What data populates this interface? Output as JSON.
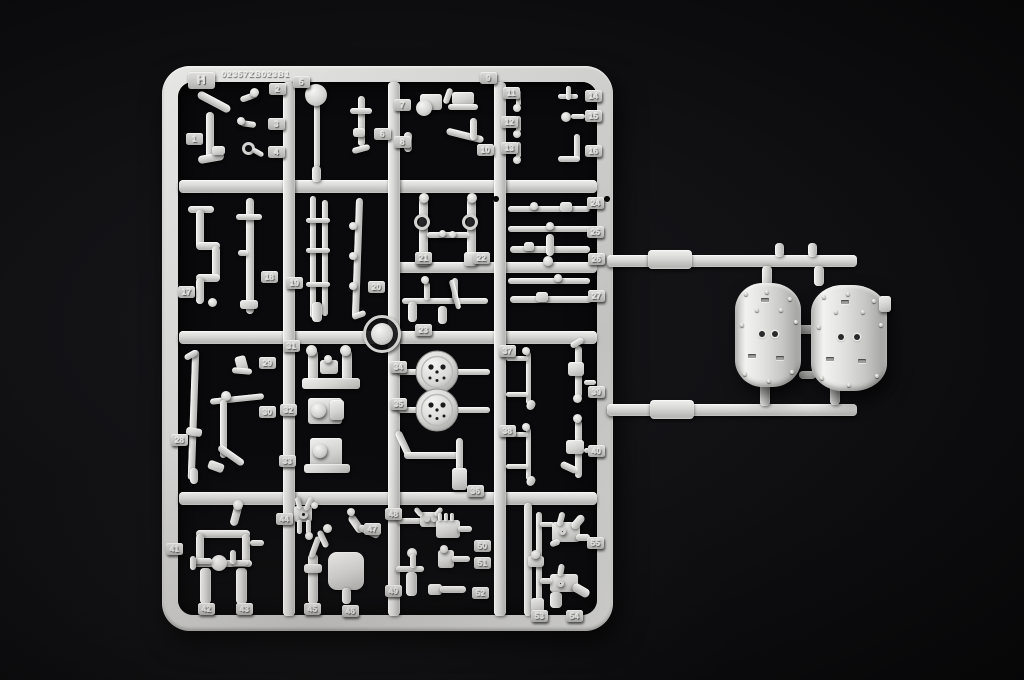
{
  "scene": {
    "type": "photograph",
    "subject": "light-gray injection-molded model kit parts sprue on black background",
    "background_color": "#0e0e11",
    "plastic_color": "#d6d6d4"
  },
  "sprue": {
    "letter": "H",
    "mold_code": "02357ZB023B1",
    "part_count": 55
  },
  "tags": [
    [
      "1",
      186,
      133
    ],
    [
      "2",
      269,
      83
    ],
    [
      "3",
      268,
      118
    ],
    [
      "4",
      268,
      146
    ],
    [
      "5",
      293,
      76
    ],
    [
      "6",
      374,
      128
    ],
    [
      "7",
      394,
      99
    ],
    [
      "8",
      394,
      136
    ],
    [
      "9",
      480,
      72
    ],
    [
      "10",
      477,
      144
    ],
    [
      "11",
      503,
      87
    ],
    [
      "12",
      501,
      116
    ],
    [
      "13",
      501,
      142
    ],
    [
      "14",
      585,
      90
    ],
    [
      "15",
      585,
      110
    ],
    [
      "16",
      585,
      145
    ],
    [
      "17",
      178,
      286
    ],
    [
      "18",
      261,
      271
    ],
    [
      "19",
      286,
      277
    ],
    [
      "20",
      368,
      281
    ],
    [
      "21",
      415,
      252
    ],
    [
      "22",
      473,
      252
    ],
    [
      "23",
      415,
      324
    ],
    [
      "24",
      587,
      197
    ],
    [
      "25",
      587,
      226
    ],
    [
      "26",
      588,
      253
    ],
    [
      "27",
      588,
      290
    ],
    [
      "28",
      171,
      434
    ],
    [
      "29",
      259,
      357
    ],
    [
      "30",
      259,
      406
    ],
    [
      "31",
      283,
      340
    ],
    [
      "32",
      280,
      404
    ],
    [
      "33",
      279,
      455
    ],
    [
      "34",
      390,
      361
    ],
    [
      "35",
      390,
      398
    ],
    [
      "36",
      467,
      485
    ],
    [
      "37",
      499,
      345
    ],
    [
      "38",
      499,
      425
    ],
    [
      "39",
      588,
      386
    ],
    [
      "40",
      588,
      445
    ],
    [
      "41",
      166,
      543
    ],
    [
      "42",
      198,
      603
    ],
    [
      "43",
      236,
      603
    ],
    [
      "44",
      276,
      513
    ],
    [
      "45",
      304,
      603
    ],
    [
      "46",
      342,
      605
    ],
    [
      "47",
      364,
      523
    ],
    [
      "48",
      385,
      508
    ],
    [
      "49",
      385,
      585
    ],
    [
      "50",
      474,
      540
    ],
    [
      "51",
      474,
      557
    ],
    [
      "52",
      472,
      587
    ],
    [
      "53",
      531,
      610
    ],
    [
      "54",
      566,
      610
    ],
    [
      "55",
      587,
      537
    ]
  ],
  "runners": [
    [
      "h",
      179,
      180,
      418,
      13
    ],
    [
      "h",
      179,
      331,
      418,
      13
    ],
    [
      "h",
      179,
      492,
      418,
      13
    ],
    [
      "h",
      394,
      262,
      203,
      11
    ],
    [
      "v",
      283,
      82,
      12,
      534
    ],
    [
      "v",
      388,
      82,
      12,
      534
    ],
    [
      "v",
      494,
      82,
      12,
      534
    ],
    [
      "v",
      524,
      503,
      8,
      113
    ],
    [
      "h",
      607,
      255,
      250,
      12
    ],
    [
      "h",
      648,
      250,
      44,
      19
    ],
    [
      "h",
      607,
      404,
      250,
      12
    ],
    [
      "h",
      650,
      400,
      44,
      19
    ],
    [
      "v",
      775,
      243,
      9,
      14
    ],
    [
      "v",
      808,
      243,
      9,
      14
    ],
    [
      "v",
      762,
      266,
      10,
      20
    ],
    [
      "v",
      814,
      266,
      10,
      20
    ],
    [
      "v",
      760,
      383,
      10,
      23
    ],
    [
      "v",
      830,
      384,
      10,
      21
    ],
    [
      "h",
      797,
      325,
      18,
      9
    ],
    [
      "h",
      799,
      371,
      17,
      8
    ]
  ],
  "holes": [
    [
      493,
      196,
      6
    ],
    [
      604,
      196,
      6
    ]
  ],
  "pieces": [
    [
      "bar",
      196,
      98,
      36,
      8,
      28
    ],
    [
      "bar",
      206,
      112,
      8,
      46
    ],
    [
      "bar",
      198,
      154,
      26,
      8,
      -10
    ],
    [
      "block",
      212,
      146,
      13,
      9
    ],
    [
      "bar",
      240,
      94,
      18,
      6,
      -20
    ],
    [
      "knob",
      250,
      88,
      9
    ],
    [
      "bar",
      240,
      121,
      16,
      6,
      8
    ],
    [
      "knob",
      237,
      117,
      8
    ],
    [
      "ring",
      242,
      142,
      13
    ],
    [
      "bar",
      252,
      150,
      12,
      5,
      30
    ],
    [
      "bar",
      314,
      98,
      6,
      70
    ],
    [
      "dome",
      305,
      84,
      22
    ],
    [
      "bar",
      312,
      166,
      9,
      16
    ],
    [
      "bar",
      358,
      96,
      7,
      50
    ],
    [
      "bar",
      350,
      108,
      22,
      6
    ],
    [
      "block",
      353,
      128,
      12,
      9
    ],
    [
      "bar",
      352,
      146,
      18,
      6,
      -15
    ],
    [
      "block",
      420,
      94,
      22,
      16
    ],
    [
      "dome",
      416,
      100,
      16
    ],
    [
      "bar",
      445,
      88,
      6,
      16,
      20
    ],
    [
      "block",
      452,
      92,
      22,
      13
    ],
    [
      "bar",
      448,
      104,
      30,
      6
    ],
    [
      "bar",
      404,
      132,
      8,
      20
    ],
    [
      "bar",
      446,
      132,
      38,
      7,
      14
    ],
    [
      "bar",
      470,
      118,
      7,
      22
    ],
    [
      "bar",
      516,
      90,
      5,
      16
    ],
    [
      "knob",
      513,
      104,
      8
    ],
    [
      "bar",
      516,
      116,
      5,
      16
    ],
    [
      "knob",
      513,
      130,
      8
    ],
    [
      "bar",
      516,
      142,
      5,
      16
    ],
    [
      "knob",
      513,
      156,
      8
    ],
    [
      "bar",
      558,
      94,
      20,
      5
    ],
    [
      "bar",
      566,
      86,
      5,
      14
    ],
    [
      "knob",
      561,
      112,
      10
    ],
    [
      "bar",
      571,
      114,
      14,
      5
    ],
    [
      "bar",
      574,
      134,
      6,
      26
    ],
    [
      "bar",
      558,
      156,
      22,
      6
    ],
    [
      "bar",
      188,
      206,
      26,
      7
    ],
    [
      "bar",
      196,
      210,
      8,
      38
    ],
    [
      "bar",
      196,
      242,
      24,
      8
    ],
    [
      "bar",
      212,
      246,
      8,
      34
    ],
    [
      "bar",
      196,
      274,
      24,
      8
    ],
    [
      "bar",
      196,
      278,
      8,
      26
    ],
    [
      "knob",
      208,
      298,
      9
    ],
    [
      "bar",
      246,
      198,
      8,
      116
    ],
    [
      "bar",
      236,
      214,
      26,
      6
    ],
    [
      "bar",
      238,
      250,
      10,
      6
    ],
    [
      "block",
      240,
      300,
      18,
      9
    ],
    [
      "bar",
      310,
      196,
      6,
      122
    ],
    [
      "bar",
      322,
      200,
      6,
      116
    ],
    [
      "bar",
      306,
      218,
      24,
      5
    ],
    [
      "bar",
      306,
      248,
      24,
      5
    ],
    [
      "bar",
      306,
      282,
      24,
      5
    ],
    [
      "bar",
      312,
      302,
      10,
      20
    ],
    [
      "bar",
      354,
      198,
      7,
      120,
      2
    ],
    [
      "knob",
      349,
      222,
      8
    ],
    [
      "knob",
      349,
      252,
      8
    ],
    [
      "knob",
      349,
      282,
      8
    ],
    [
      "bar",
      352,
      312,
      14,
      6,
      -20
    ],
    [
      "bar",
      419,
      198,
      9,
      60
    ],
    [
      "ring",
      414,
      214,
      16
    ],
    [
      "knob",
      419,
      193,
      10
    ],
    [
      "block",
      416,
      252,
      13,
      14
    ],
    [
      "bar",
      467,
      198,
      9,
      60
    ],
    [
      "ring",
      462,
      214,
      16
    ],
    [
      "knob",
      467,
      193,
      10
    ],
    [
      "block",
      464,
      252,
      13,
      14
    ],
    [
      "bar",
      427,
      232,
      42,
      6
    ],
    [
      "knob",
      439,
      230,
      7
    ],
    [
      "knob",
      449,
      231,
      7
    ],
    [
      "bar",
      402,
      298,
      86,
      6
    ],
    [
      "bar",
      424,
      282,
      6,
      18
    ],
    [
      "knob",
      421,
      276,
      8
    ],
    [
      "bar",
      452,
      278,
      6,
      22
    ],
    [
      "bar",
      440,
      292,
      30,
      5,
      75
    ],
    [
      "bar",
      408,
      302,
      9,
      20
    ],
    [
      "bar",
      438,
      306,
      9,
      18
    ],
    [
      "bar",
      508,
      206,
      82,
      6
    ],
    [
      "knob",
      530,
      202,
      8
    ],
    [
      "block",
      560,
      202,
      12,
      10
    ],
    [
      "bar",
      508,
      226,
      84,
      6
    ],
    [
      "knob",
      546,
      222,
      8
    ],
    [
      "bar",
      510,
      246,
      80,
      7
    ],
    [
      "block",
      524,
      242,
      10,
      9
    ],
    [
      "bar",
      546,
      234,
      8,
      22
    ],
    [
      "knob",
      543,
      256,
      10
    ],
    [
      "bar",
      508,
      278,
      82,
      6
    ],
    [
      "knob",
      554,
      274,
      8
    ],
    [
      "bar",
      510,
      296,
      82,
      7
    ],
    [
      "block",
      536,
      292,
      12,
      10
    ],
    [
      "ring",
      363,
      315,
      38
    ],
    [
      "dome",
      371,
      323,
      22
    ],
    [
      "bar",
      190,
      350,
      7,
      130,
      2
    ],
    [
      "bar",
      184,
      352,
      14,
      6,
      -30
    ],
    [
      "block",
      186,
      428,
      16,
      8,
      10
    ],
    [
      "bar",
      190,
      468,
      8,
      16
    ],
    [
      "block",
      236,
      356,
      11,
      16,
      -15
    ],
    [
      "bar",
      232,
      368,
      20,
      6,
      5
    ],
    [
      "bar",
      210,
      396,
      54,
      6,
      -6
    ],
    [
      "knob",
      221,
      391,
      10
    ],
    [
      "bar",
      220,
      400,
      7,
      58
    ],
    [
      "bar",
      216,
      452,
      30,
      7,
      35
    ],
    [
      "block",
      208,
      462,
      16,
      9,
      20
    ],
    [
      "bar",
      308,
      350,
      10,
      32
    ],
    [
      "knob",
      306,
      345,
      11
    ],
    [
      "bar",
      342,
      350,
      10,
      32
    ],
    [
      "knob",
      340,
      345,
      11
    ],
    [
      "block",
      302,
      378,
      58,
      11
    ],
    [
      "block",
      320,
      360,
      18,
      14
    ],
    [
      "knob",
      324,
      355,
      8
    ],
    [
      "block",
      308,
      398,
      34,
      26
    ],
    [
      "dome",
      311,
      403,
      15
    ],
    [
      "block",
      330,
      400,
      14,
      20
    ],
    [
      "block",
      310,
      438,
      32,
      30
    ],
    [
      "dome",
      313,
      444,
      14
    ],
    [
      "block",
      304,
      464,
      46,
      9
    ],
    [
      "bar",
      398,
      369,
      92,
      6
    ],
    [
      "wheel",
      415,
      350,
      44
    ],
    [
      "bar",
      398,
      407,
      92,
      6
    ],
    [
      "wheel",
      415,
      388,
      44
    ],
    [
      "bar",
      400,
      430,
      7,
      28,
      -25
    ],
    [
      "bar",
      404,
      452,
      56,
      7
    ],
    [
      "bar",
      456,
      438,
      7,
      36
    ],
    [
      "block",
      452,
      468,
      15,
      22
    ],
    [
      "bar",
      526,
      352,
      5,
      52
    ],
    [
      "bar",
      506,
      356,
      22,
      5
    ],
    [
      "bar",
      506,
      392,
      22,
      5
    ],
    [
      "knob",
      522,
      347,
      8
    ],
    [
      "bar",
      527,
      400,
      8,
      10,
      30
    ],
    [
      "bar",
      526,
      428,
      5,
      52
    ],
    [
      "bar",
      506,
      432,
      22,
      5
    ],
    [
      "bar",
      506,
      464,
      22,
      5
    ],
    [
      "knob",
      522,
      423,
      8
    ],
    [
      "bar",
      527,
      476,
      8,
      10,
      30
    ],
    [
      "bar",
      575,
      346,
      7,
      52
    ],
    [
      "block",
      568,
      362,
      16,
      14
    ],
    [
      "bar",
      570,
      340,
      14,
      6,
      -30
    ],
    [
      "knob",
      573,
      394,
      9
    ],
    [
      "bar",
      584,
      380,
      12,
      5
    ],
    [
      "bar",
      575,
      420,
      7,
      58
    ],
    [
      "block",
      566,
      440,
      18,
      14
    ],
    [
      "bar",
      560,
      464,
      18,
      7,
      25
    ],
    [
      "knob",
      573,
      414,
      9
    ],
    [
      "bar",
      584,
      448,
      12,
      5
    ],
    [
      "bar",
      232,
      504,
      8,
      22,
      15
    ],
    [
      "knob",
      233,
      500,
      10
    ],
    [
      "bar",
      196,
      530,
      54,
      8
    ],
    [
      "bar",
      196,
      534,
      8,
      32
    ],
    [
      "bar",
      242,
      534,
      8,
      32
    ],
    [
      "bar",
      192,
      560,
      60,
      7
    ],
    [
      "dome",
      211,
      555,
      16
    ],
    [
      "bar",
      250,
      540,
      14,
      6
    ],
    [
      "bar",
      200,
      568,
      11,
      36
    ],
    [
      "bar",
      192,
      558,
      20,
      6
    ],
    [
      "bar",
      190,
      556,
      6,
      14
    ],
    [
      "bar",
      236,
      568,
      11,
      36
    ],
    [
      "bar",
      232,
      560,
      16,
      6
    ],
    [
      "bar",
      230,
      550,
      6,
      14
    ],
    [
      "block",
      294,
      506,
      18,
      16
    ],
    [
      "ring",
      299,
      510,
      9
    ],
    [
      "bar",
      306,
      497,
      5,
      14,
      25
    ],
    [
      "bar",
      296,
      497,
      5,
      12,
      -15
    ],
    [
      "bar",
      297,
      520,
      5,
      14
    ],
    [
      "bar",
      306,
      520,
      5,
      14
    ],
    [
      "knob",
      311,
      502,
      7
    ],
    [
      "bar",
      308,
      554,
      10,
      50
    ],
    [
      "block",
      304,
      564,
      18,
      9
    ],
    [
      "bar",
      312,
      536,
      6,
      22,
      20
    ],
    [
      "bar",
      320,
      530,
      6,
      18,
      -25
    ],
    [
      "knob",
      323,
      524,
      9
    ],
    [
      "knob",
      305,
      532,
      8
    ],
    [
      "pad",
      328,
      552,
      36,
      38
    ],
    [
      "bar",
      342,
      588,
      9,
      16
    ],
    [
      "bar",
      352,
      514,
      8,
      20,
      -35
    ],
    [
      "bar",
      358,
      528,
      22,
      7,
      25
    ],
    [
      "knob",
      347,
      508,
      8
    ],
    [
      "bar",
      398,
      518,
      24,
      6
    ],
    [
      "block",
      420,
      512,
      18,
      15
    ],
    [
      "ring",
      424,
      516,
      6
    ],
    [
      "ring",
      431,
      516,
      6
    ],
    [
      "bar",
      436,
      507,
      5,
      10,
      40
    ],
    [
      "bar",
      416,
      507,
      5,
      10,
      -40
    ],
    [
      "bar",
      396,
      566,
      28,
      6
    ],
    [
      "knob",
      407,
      548,
      10
    ],
    [
      "bar",
      410,
      554,
      6,
      14
    ],
    [
      "bar",
      406,
      572,
      11,
      24
    ],
    [
      "block",
      436,
      520,
      24,
      18
    ],
    [
      "bar",
      438,
      513,
      4,
      8
    ],
    [
      "bar",
      444,
      513,
      4,
      8
    ],
    [
      "bar",
      450,
      513,
      4,
      8
    ],
    [
      "bar",
      458,
      526,
      14,
      6
    ],
    [
      "block",
      438,
      550,
      16,
      18
    ],
    [
      "knob",
      440,
      545,
      8
    ],
    [
      "bar",
      452,
      556,
      18,
      6
    ],
    [
      "block",
      428,
      584,
      14,
      11
    ],
    [
      "bar",
      440,
      586,
      26,
      7
    ],
    [
      "bar",
      536,
      512,
      6,
      94
    ],
    [
      "block",
      528,
      556,
      16,
      11
    ],
    [
      "knob",
      531,
      550,
      9
    ],
    [
      "bar",
      540,
      522,
      14,
      5
    ],
    [
      "block",
      531,
      598,
      13,
      14
    ],
    [
      "block",
      552,
      522,
      28,
      20
    ],
    [
      "bar",
      558,
      512,
      6,
      14,
      15
    ],
    [
      "bar",
      574,
      514,
      8,
      16,
      40
    ],
    [
      "ring",
      559,
      528,
      7
    ],
    [
      "bar",
      576,
      534,
      14,
      7
    ],
    [
      "bar",
      550,
      540,
      10,
      6,
      -20
    ],
    [
      "block",
      550,
      574,
      28,
      18
    ],
    [
      "bar",
      572,
      586,
      18,
      9,
      30
    ],
    [
      "ring",
      557,
      580,
      7
    ],
    [
      "bar",
      550,
      592,
      12,
      16
    ],
    [
      "bar",
      558,
      564,
      6,
      12,
      10
    ],
    [
      "bar",
      540,
      578,
      12,
      6
    ]
  ],
  "shells": [
    [
      735,
      283,
      66,
      104
    ],
    [
      811,
      285,
      76,
      106
    ]
  ],
  "shell_tab": [
    879,
    296,
    12,
    16
  ]
}
